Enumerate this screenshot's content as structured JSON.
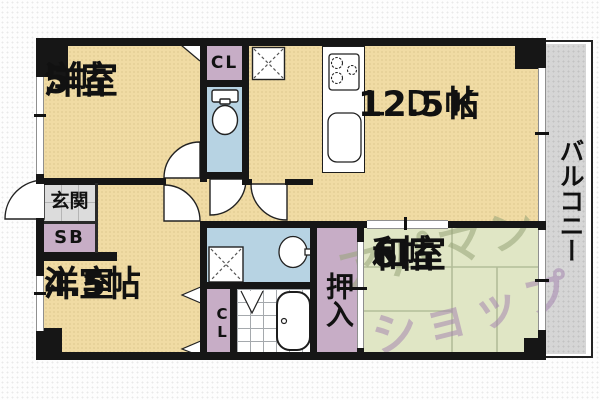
{
  "floorplan": {
    "rooms": {
      "western1": {
        "name": "洋室",
        "size": "5帖"
      },
      "ldk": {
        "name": "ＬＤＫ",
        "size": "12.5帖"
      },
      "western2": {
        "name": "洋室",
        "size": "4.5帖"
      },
      "japanese": {
        "name": "和室",
        "size": "6帖"
      }
    },
    "labels": {
      "balcony": "バルコニー",
      "entrance": "玄関",
      "shoe_box": "SB",
      "closet_top": "CL",
      "closet_bottom": "CL",
      "oshiire": "押入"
    },
    "watermark": {
      "line1": "アパマン",
      "line2": "ショップ"
    },
    "colors": {
      "wall": "#161616",
      "room_cream": "#f0dba4",
      "closet_pink": "#c7adc6",
      "wet_blue": "#b7d3e3",
      "tatami_green": "#e0e6c5",
      "balcony_gray": "#d6d6d6",
      "entrance_gray": "#dcdcdc",
      "watermark_green": "#96a478",
      "watermark_purple": "#a687b0"
    }
  }
}
